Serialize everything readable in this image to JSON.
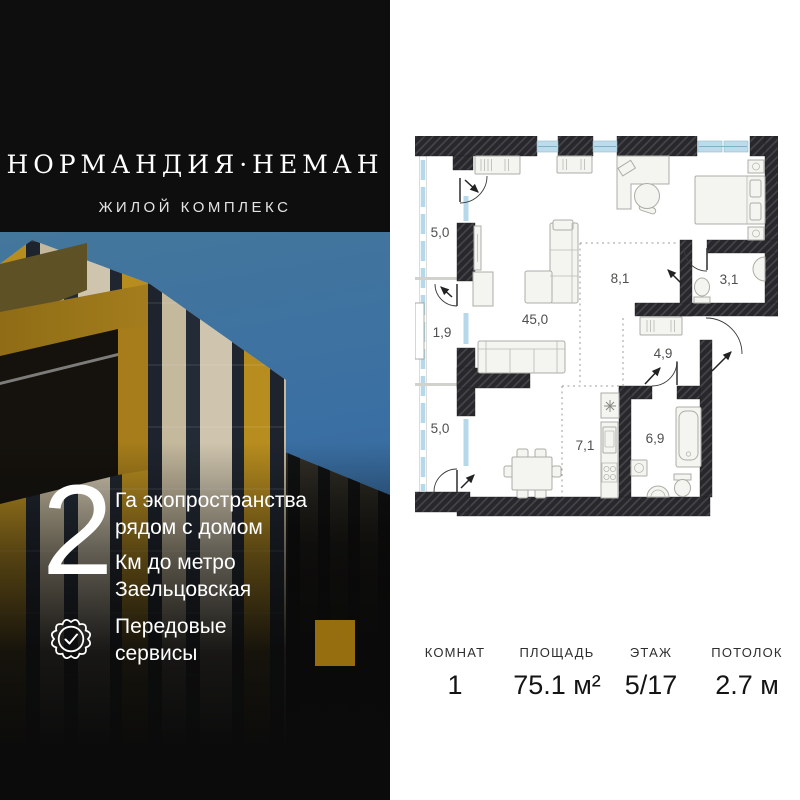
{
  "brand": {
    "title": "НОРМАНДИЯ·НЕМАН",
    "subtitle": "ЖИЛОЙ КОМПЛЕКС"
  },
  "features": {
    "number": "2",
    "items": [
      {
        "text": "Га экопространства\nрядом с домом"
      },
      {
        "text": "Км до метро\nЗаельцовская"
      },
      {
        "icon": "seal-check-icon",
        "text": "Передовые\nсервисы"
      }
    ]
  },
  "floor_plan": {
    "rooms": [
      {
        "name": "balcony-top",
        "area": "5,0"
      },
      {
        "name": "balcony-middle",
        "area": "1,9"
      },
      {
        "name": "balcony-bottom",
        "area": "5,0"
      },
      {
        "name": "living-room",
        "area": "45,0"
      },
      {
        "name": "bedroom-zone",
        "area": "8,1"
      },
      {
        "name": "bathroom-small",
        "area": "3,1"
      },
      {
        "name": "hallway",
        "area": "4,9"
      },
      {
        "name": "kitchen",
        "area": "7,1"
      },
      {
        "name": "bathroom-large",
        "area": "6,9"
      }
    ]
  },
  "stats": {
    "columns": [
      {
        "label": "КОМНАТ",
        "value": "1"
      },
      {
        "label": "ПЛОЩАДЬ",
        "value": "75.1 м²"
      },
      {
        "label": "ЭТАЖ",
        "value": "5/17"
      },
      {
        "label": "ПОТОЛОК",
        "value": "2.7 м"
      }
    ]
  },
  "colors": {
    "panel_bg": "#0b0b0b",
    "page_bg": "#ffffff",
    "window_blue": "#b5d9ea",
    "wall_dark": "#28282c",
    "gold_accent": "#bf9226",
    "sky_blue": "#3a6fa3",
    "label_gray": "#4f4f4c"
  }
}
